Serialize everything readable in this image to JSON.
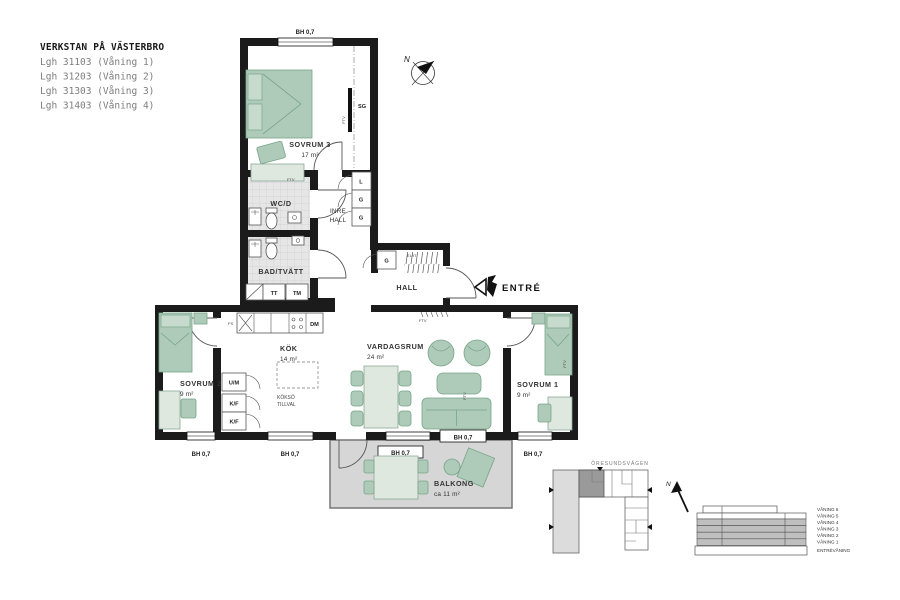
{
  "project": {
    "title": "VERKSTAN PÅ VÄSTERBRO",
    "apartments": [
      "Lgh 31103 (Våning 1)",
      "Lgh 31203 (Våning 2)",
      "Lgh 31303 (Våning 3)",
      "Lgh 31403 (Våning 4)"
    ]
  },
  "rooms": {
    "sovrum3": {
      "name": "SOVRUM 3",
      "area": "17 m²"
    },
    "wcd": {
      "name": "WC/D"
    },
    "inre_hall": {
      "line1": "INRE",
      "line2": "HALL"
    },
    "bad": {
      "name": "BAD/TVÄTT"
    },
    "hall": {
      "name": "HALL"
    },
    "kok": {
      "name": "KÖK",
      "area": "14 m²"
    },
    "vardagsrum": {
      "name": "VARDAGSRUM",
      "area": "24 m²"
    },
    "sovrum2": {
      "name": "SOVRUM 2",
      "area": "9 m²"
    },
    "sovrum1": {
      "name": "SOVRUM 1",
      "area": "9 m²"
    },
    "balkong": {
      "name": "BALKONG",
      "area": "ca 11 m²"
    }
  },
  "labels": {
    "entre": "ENTRÉ",
    "bh": "BH 0,7",
    "sg": "SG",
    "l": "L",
    "g": "G",
    "um": "U/M",
    "kf": "K/F",
    "dm": "DM",
    "tt": "TT",
    "tm": "TM",
    "elit": "EL/IT",
    "fs": "FS",
    "ftv": "FTV",
    "kokso_line1": "KÖKSÖ",
    "kokso_line2": "TILLVAL",
    "north": "N"
  },
  "site": {
    "street": "ÖRESUNDSVÄGEN",
    "floors": [
      "VÅNING 6",
      "VÅNING 5",
      "VÅNING 4",
      "VÅNING 3",
      "VÅNING 2",
      "VÅNING 1",
      "ENTRÉVÅNING"
    ]
  },
  "colors": {
    "wall": "#1b1b1b",
    "furniture": "#aecab8",
    "furniture_stroke": "#79a58b",
    "tile": "#e6e6e6",
    "balcony": "#d6d6d6",
    "highlight_unit": "#9a9a9a",
    "floor_gray": "#bfbfbf"
  }
}
